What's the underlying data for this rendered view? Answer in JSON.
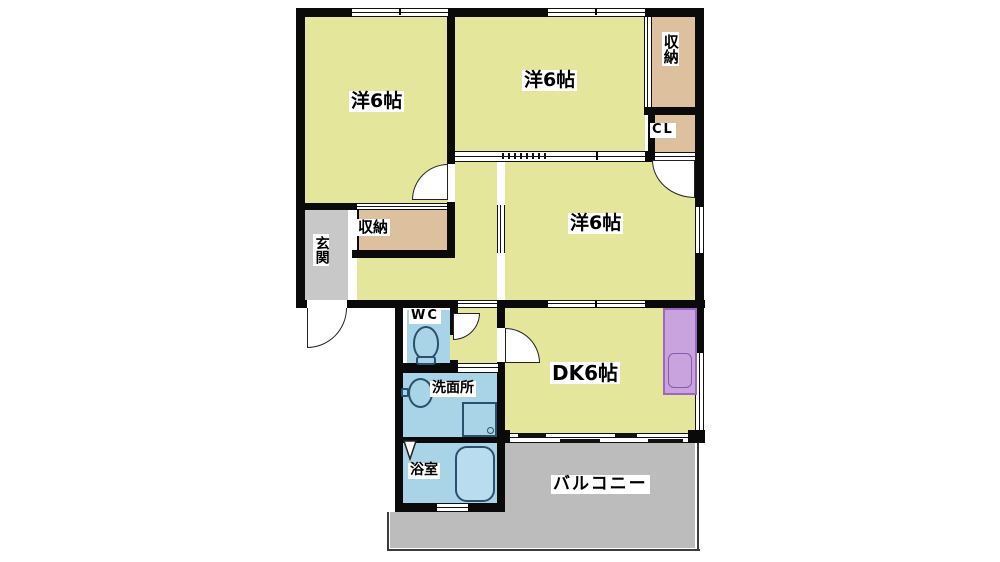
{
  "floorplan": {
    "labels": {
      "room_top_left": "洋6帖",
      "room_top_middle": "洋6帖",
      "room_middle": "洋6帖",
      "storage_top_right": "収納",
      "closet": "CL",
      "storage_middle": "収納",
      "entrance": "玄関",
      "toilet": "WC",
      "washroom": "洗面所",
      "dining_kitchen": "DK6帖",
      "bathroom": "浴室",
      "balcony": "バルコニー"
    },
    "colors": {
      "wall": "#0a0a0a",
      "room_fill": "#e4e79b",
      "storage_fill": "#ddc09e",
      "entrance_fill": "#c8c8c8",
      "water_fill": "#a9d3e6",
      "kitchen_counter_fill": "#c9a3de",
      "balcony_fill": "#bcbcbc",
      "label_background": "#ffffff"
    }
  }
}
